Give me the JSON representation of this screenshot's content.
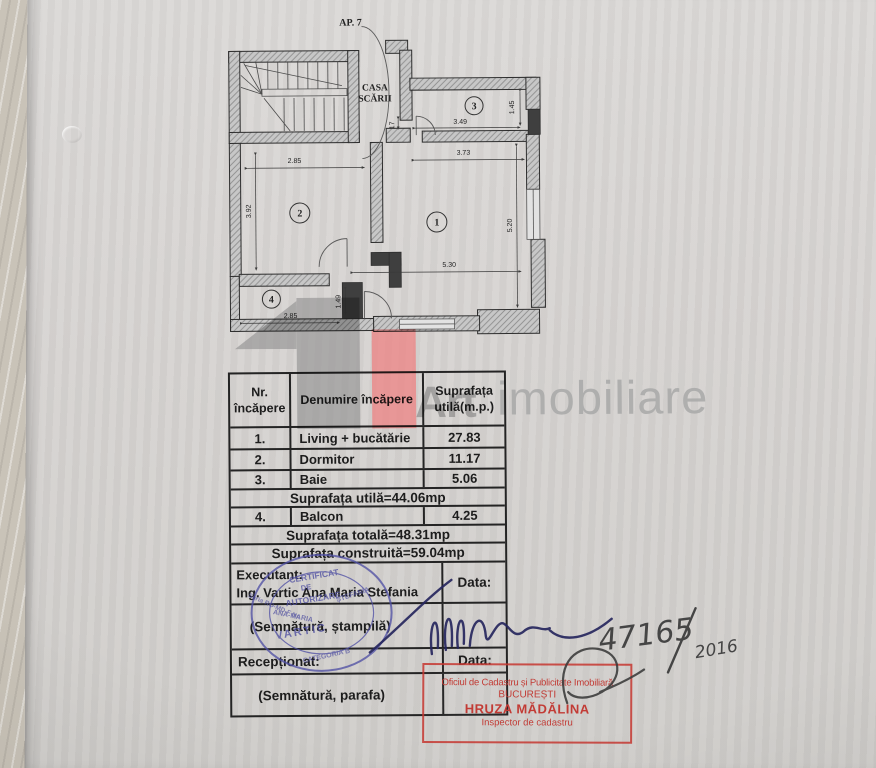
{
  "plan": {
    "apartment_label": "AP. 7",
    "staircase_label_line1": "CASA",
    "staircase_label_line2": "SCĂRII",
    "rooms": [
      {
        "number": "1"
      },
      {
        "number": "2"
      },
      {
        "number": "3"
      },
      {
        "number": "4"
      }
    ],
    "dimensions": {
      "room2_width": "2.85",
      "room2_height": "3.92",
      "balcony_width": "2.85",
      "balcony_height": "1.49",
      "living_width": "5.30",
      "living_height": "5.20",
      "living_top": "3.73",
      "bath_width": "3.49",
      "bath_height": "1.45",
      "entry": "17"
    }
  },
  "watermark": {
    "brand_bold": "Art",
    "brand_light": "imobiliare",
    "gray": "#8f8f8f",
    "red": "#ef8080"
  },
  "table": {
    "headers": [
      "Nr. încăpere",
      "Denumire încăpere",
      "Suprafața utilă(m.p.)"
    ],
    "rows": [
      {
        "nr": "1.",
        "name": "Living + bucătărie",
        "value": "27.83"
      },
      {
        "nr": "2.",
        "name": "Dormitor",
        "value": "11.17"
      },
      {
        "nr": "3.",
        "name": "Baie",
        "value": "5.06"
      }
    ],
    "subtotal": "Suprafața utilă=44.06mp",
    "balcony_row": {
      "nr": "4.",
      "name": "Balcon",
      "value": "4.25"
    },
    "total": "Suprafața totală=48.31mp",
    "built": "Suprafața construită=59.04mp",
    "executant_label": "Executant:",
    "executant_name": "Ing. Vartic Ana Maria Stefania",
    "date_label": "Data:",
    "signature_stamp_label": "(Semnătură, ștampilă)",
    "received_label": "Recepționat:",
    "date_label2": "Data:",
    "signature_seal_label": "(Semnătură, parafa)"
  },
  "round_stamp": {
    "line1": "CERTIFICAT",
    "line2": "DE",
    "line3": "AUTORIZARE",
    "serial": "Seria RO-MD-F Nr.",
    "arc_name1": "ANA-MARIA",
    "arc_name2": "ȘTEFANIA",
    "name": "VARTIC",
    "category": "CATEGORIA B",
    "color": "#5151a5"
  },
  "red_stamp": {
    "line1": "Oficiul de Cadastru și Publicitate Imobiliară",
    "line2": "BUCUREȘTI",
    "line3": "HRUZA MĂDĂLINA",
    "line4": "Inspector de cadastru",
    "color": "#c23b35"
  },
  "handwritten": {
    "number": "47165",
    "year": "2016"
  }
}
